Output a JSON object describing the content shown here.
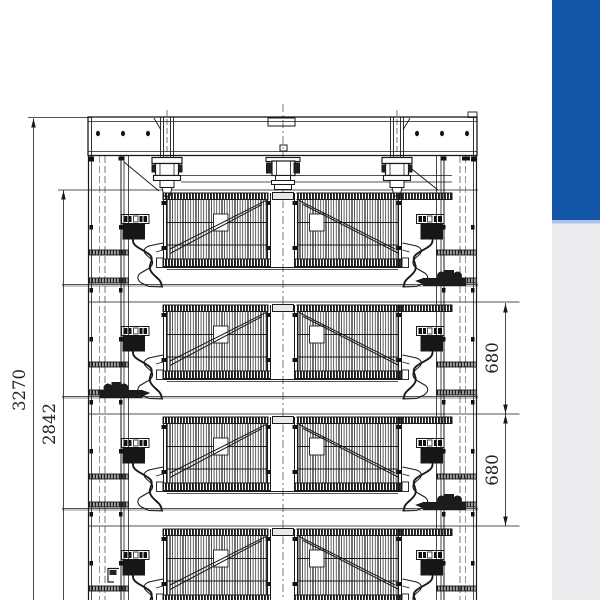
{
  "drawing": {
    "dimension_labels": {
      "overall_height": "3270",
      "frame_height": "2842",
      "tier_gap_upper": "680",
      "tier_gap_lower": "680"
    },
    "colors": {
      "blue_panel": "#1254a5",
      "blue_panel_edge": "#aec4e5",
      "gray_panel": "#eaecef",
      "ink": "#1a1a1a"
    }
  }
}
